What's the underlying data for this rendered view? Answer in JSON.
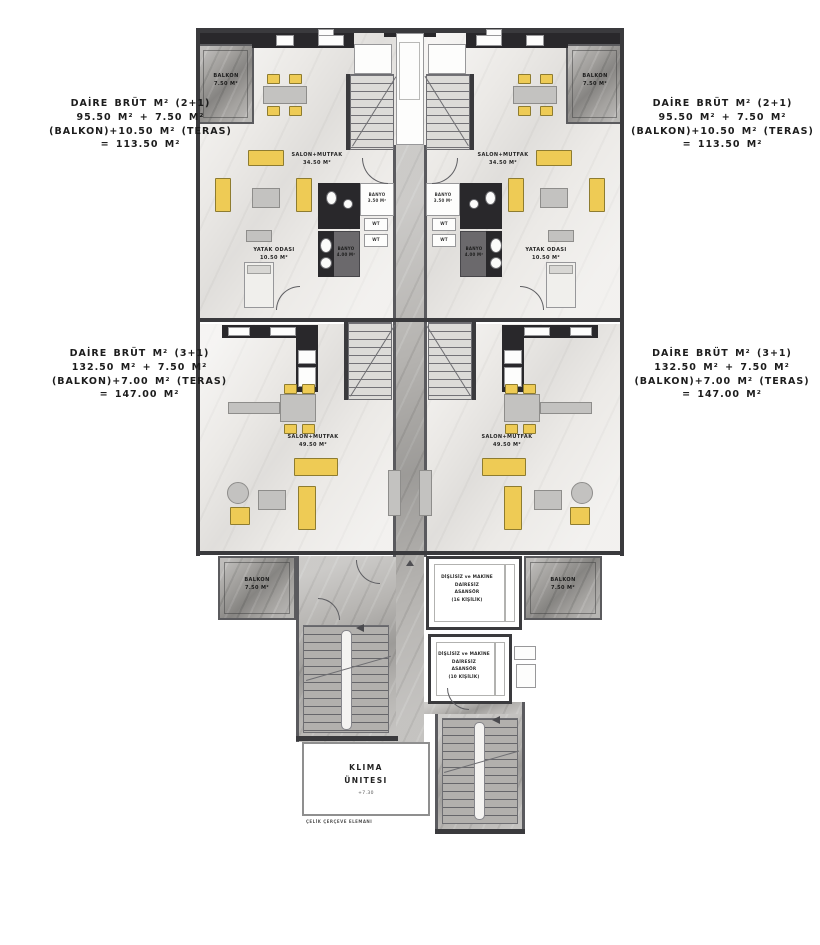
{
  "annotations": {
    "unit_2plus1_left": "DAİRE BRÜT M² (2+1)\n95.50 M² + 7.50 M²\n(BALKON)+10.50 M² (TERAS)\n= 113.50 M²",
    "unit_2plus1_right": "DAİRE BRÜT M² (2+1)\n95.50 M² + 7.50 M²\n(BALKON)+10.50 M² (TERAS)\n= 113.50 M²",
    "unit_3plus1_left": "DAİRE BRÜT M² (3+1)\n132.50 M² + 7.50 M²\n(BALKON)+7.00 M² (TERAS)\n= 147.00 M²",
    "unit_3plus1_right": "DAİRE BRÜT M² (3+1)\n132.50 M² + 7.50 M²\n(BALKON)+7.00 M² (TERAS)\n= 147.00 M²"
  },
  "rooms": {
    "balkon_top_left": "BALKON\n7.50 M²",
    "balkon_top_right": "BALKON\n7.50 M²",
    "salon_2plus1_left": "SALON+MUTFAK\n34.50 M²",
    "salon_2plus1_right": "SALON+MUTFAK\n34.50 M²",
    "banyo_small_left": "BANYO\n3.50 M²",
    "banyo_small_right": "BANYO\n3.50 M²",
    "banyo_big_left": "BANYO\n4.00 M²",
    "banyo_big_right": "BANYO\n4.00 M²",
    "yatak_left": "YATAK ODASI\n10.50 M²",
    "yatak_right": "YATAK ODASI\n10.50 M²",
    "salon_3plus1_left": "SALON+MUTFAK\n49.50 M²",
    "salon_3plus1_right": "SALON+MUTFAK\n49.50 M²",
    "balkon_bottom_left": "BALKON\n7.50 M²",
    "balkon_bottom_right": "BALKON\n7.50 M²",
    "elevator_16": "DİŞLİSİZ ve MAKİNE DAİRESİZ\nASANSÖR\n(16 KİŞİLİK)",
    "elevator_10": "DİŞLİSİZ ve MAKİNE DAİRESİZ\nASANSÖR\n(10 KİŞİLİK)",
    "klima": "KLIMA\nÜNITESI",
    "klima_level": "+7.30",
    "steel_frame": "ÇELİK ÇERÇEVE ELEMANI",
    "wt": "WT"
  },
  "colors": {
    "furniture_accent": "#eecb55",
    "wall": "#3a3a3d",
    "floor": "#eceae7",
    "balcony_marble": "#a3a19e",
    "corridor_marble": "#b6b4b1",
    "bathroom_dark": "#29282b"
  }
}
